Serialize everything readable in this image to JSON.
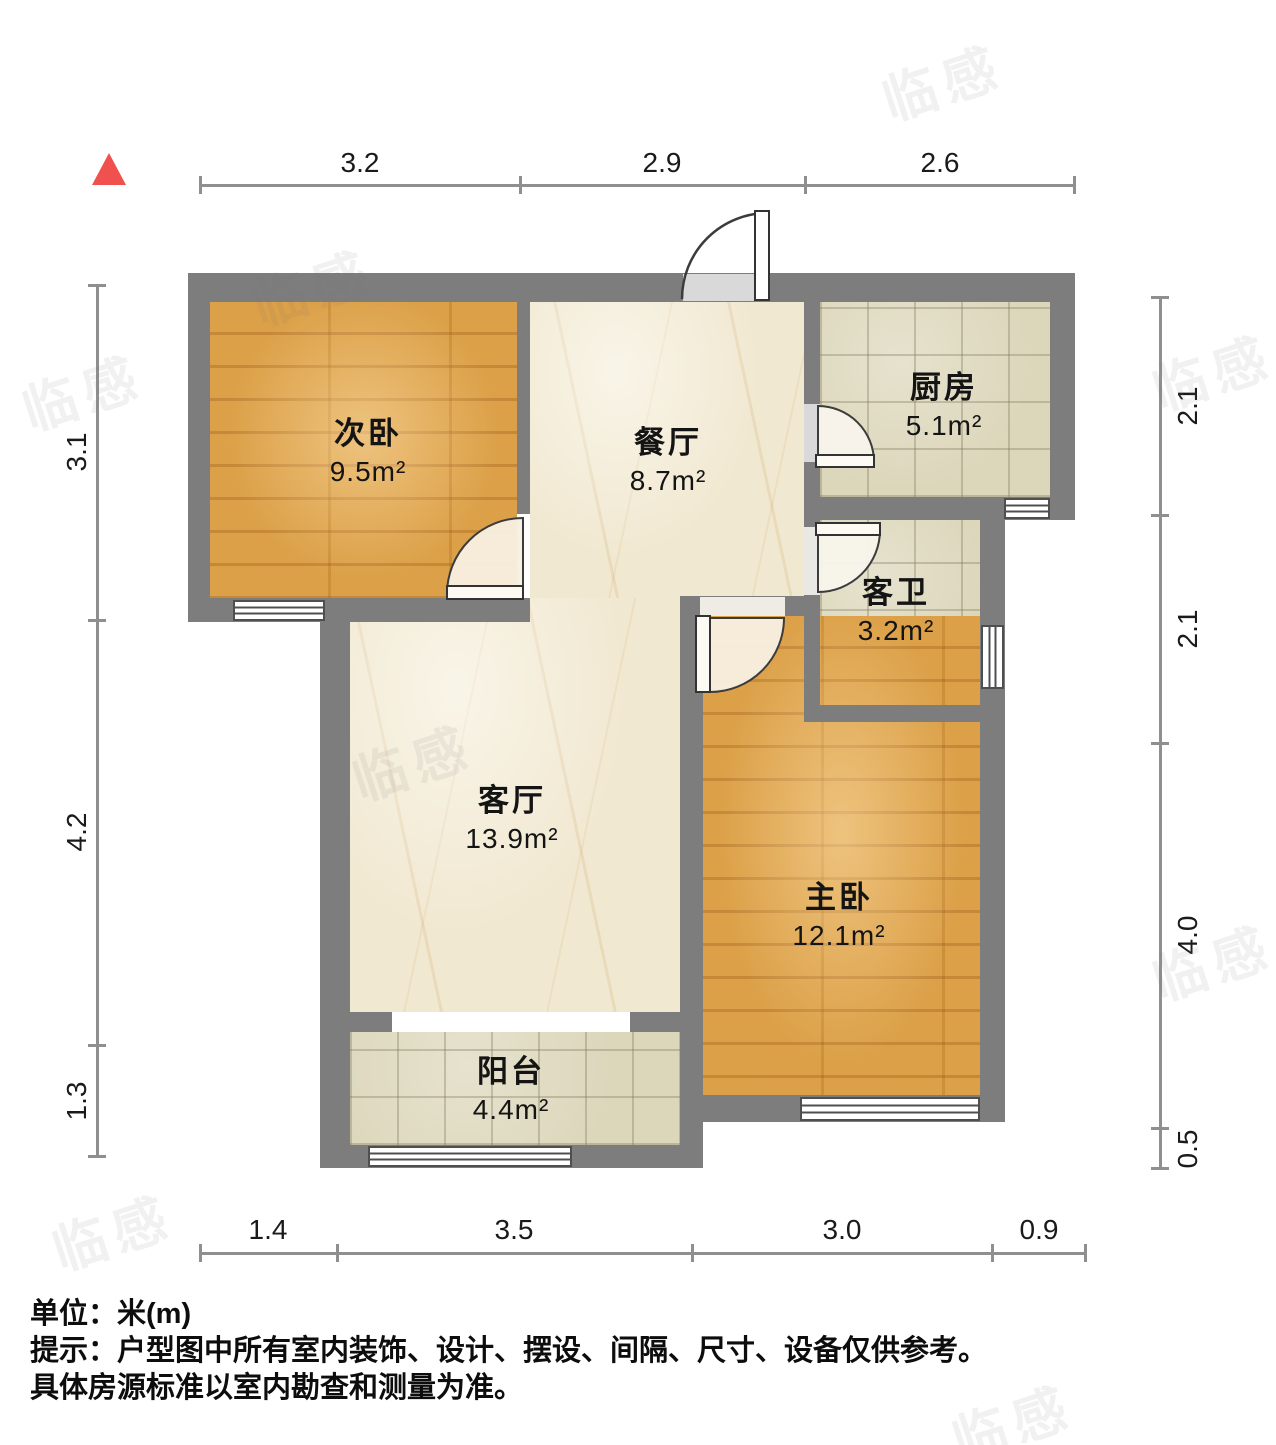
{
  "rooms": [
    {
      "id": "secondary-bedroom",
      "name": "次卧",
      "area": "9.5m²"
    },
    {
      "id": "dining-room",
      "name": "餐厅",
      "area": "8.7m²"
    },
    {
      "id": "kitchen",
      "name": "厨房",
      "area": "5.1m²"
    },
    {
      "id": "guest-bathroom",
      "name": "客卫",
      "area": "3.2m²"
    },
    {
      "id": "living-room",
      "name": "客厅",
      "area": "13.9m²"
    },
    {
      "id": "master-bedroom",
      "name": "主卧",
      "area": "12.1m²"
    },
    {
      "id": "balcony",
      "name": "阳台",
      "area": "4.4m²"
    }
  ],
  "dimensions": {
    "top": [
      "3.2",
      "2.9",
      "2.6"
    ],
    "left": [
      "3.1",
      "4.2",
      "1.3"
    ],
    "right": [
      "2.1",
      "2.1",
      "4.0",
      "0.5"
    ],
    "bottom": [
      "1.4",
      "3.5",
      "3.0",
      "0.9"
    ]
  },
  "footer": {
    "unit_label": "单位：米(m)",
    "tip_line1": "提示：户型图中所有室内装饰、设计、摆设、间隔、尺寸、设备仅供参考。",
    "tip_line2": "具体房源标准以室内勘查和测量为准。"
  },
  "watermark": {
    "text": "临感"
  },
  "colors": {
    "wall": "#7d7d7d",
    "wood_floor": "#d6993f",
    "tile_floor": "#dcd7bb",
    "marble_floor": "#f1e8d1",
    "north_arrow": "#f0504e",
    "dimension_text": "#1a1a1a"
  }
}
